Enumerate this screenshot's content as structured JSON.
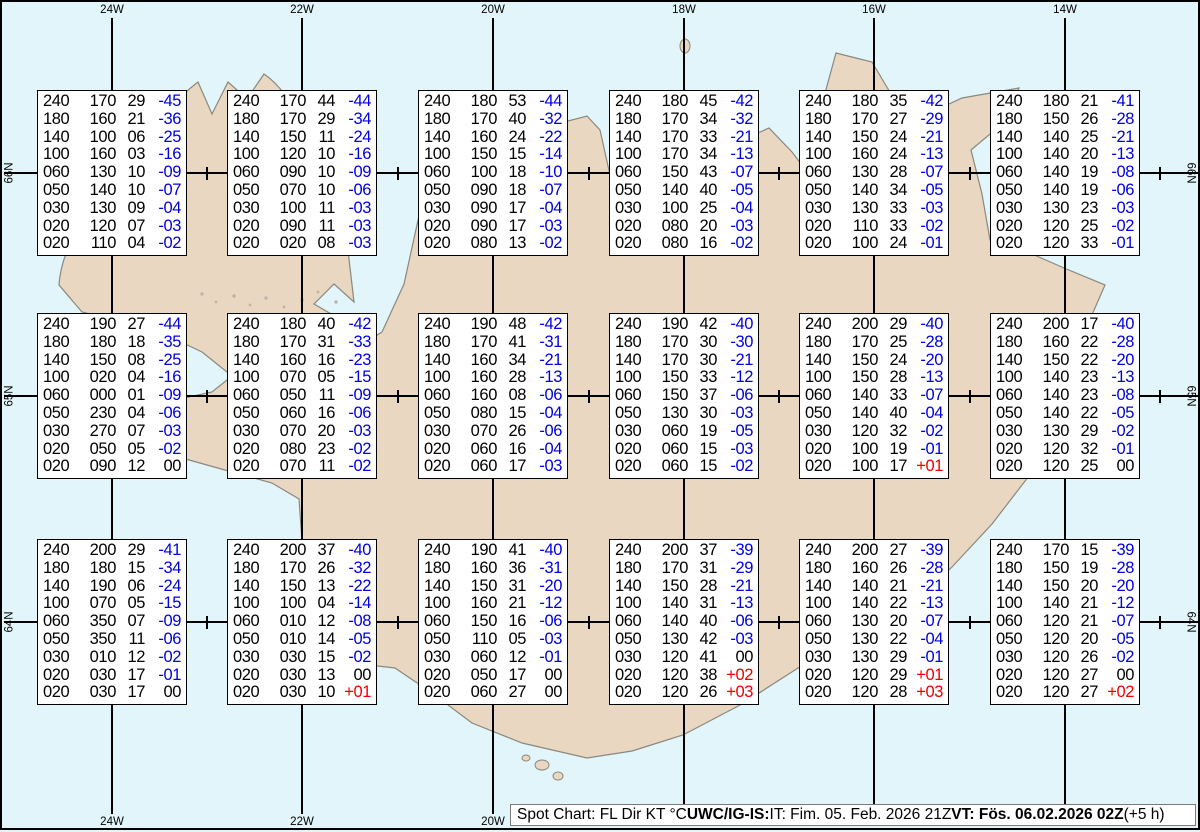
{
  "title": "Spot Chart UWC/IG-IS Iceland",
  "colors": {
    "sea": "#e1f5fa",
    "land": "#e9d7c2",
    "coastline": "#8a887e",
    "grid": "#000000",
    "temp_negative": "#0000e0",
    "temp_positive": "#ee0000",
    "temp_zero": "#000000",
    "box_bg": "#ffffff",
    "status_bg": "#ffffff"
  },
  "axes": {
    "top_labels": [
      "24W",
      "22W",
      "20W",
      "18W",
      "16W",
      "14W"
    ],
    "bottom_labels": [
      "24W",
      "22W",
      "20W"
    ],
    "left_labels": [
      "66N",
      "65N",
      "64N"
    ],
    "right_labels": [
      "66N",
      "65N",
      "64N"
    ]
  },
  "status_bar": {
    "segments": [
      {
        "text": "Spot Chart: FL Dir KT °C ",
        "bold": false
      },
      {
        "text": "UWC/IG-IS:",
        "bold": true
      },
      {
        "text": " IT: Fim. 05. Feb. 2026 21Z ",
        "bold": false
      },
      {
        "text": "VT: Fös. 06.02.2026 02Z",
        "bold": true
      },
      {
        "text": " (+5 h)",
        "bold": false
      }
    ]
  },
  "chart_data": {
    "type": "table",
    "title": "Spot Chart: FL Dir KT °C",
    "issued": "IT: Fim. 05. Feb. 2026 21Z",
    "valid": "VT: Fös. 06.02.2026 02Z (+5 h)",
    "columns": [
      "FL",
      "Dir",
      "KT",
      "°C"
    ],
    "grid_lons": [
      "24W",
      "22W",
      "20W",
      "18W",
      "16W",
      "14W"
    ],
    "grid_lats": [
      "66N",
      "65N",
      "64N"
    ],
    "stations": [
      {
        "row": 0,
        "col": 0,
        "rows": [
          [
            "240",
            "170",
            "29",
            "-45"
          ],
          [
            "180",
            "160",
            "21",
            "-36"
          ],
          [
            "140",
            "100",
            "06",
            "-25"
          ],
          [
            "100",
            "160",
            "03",
            "-16"
          ],
          [
            "060",
            "130",
            "10",
            "-09"
          ],
          [
            "050",
            "140",
            "10",
            "-07"
          ],
          [
            "030",
            "130",
            "09",
            "-04"
          ],
          [
            "020",
            "120",
            "07",
            "-03"
          ],
          [
            "020",
            "110",
            "04",
            "-02"
          ]
        ]
      },
      {
        "row": 0,
        "col": 1,
        "rows": [
          [
            "240",
            "170",
            "44",
            "-44"
          ],
          [
            "180",
            "170",
            "29",
            "-34"
          ],
          [
            "140",
            "150",
            "11",
            "-24"
          ],
          [
            "100",
            "120",
            "10",
            "-16"
          ],
          [
            "060",
            "090",
            "10",
            "-09"
          ],
          [
            "050",
            "070",
            "10",
            "-06"
          ],
          [
            "030",
            "100",
            "11",
            "-03"
          ],
          [
            "020",
            "090",
            "11",
            "-03"
          ],
          [
            "020",
            "020",
            "08",
            "-03"
          ]
        ]
      },
      {
        "row": 0,
        "col": 2,
        "rows": [
          [
            "240",
            "180",
            "53",
            "-44"
          ],
          [
            "180",
            "170",
            "40",
            "-32"
          ],
          [
            "140",
            "160",
            "24",
            "-22"
          ],
          [
            "100",
            "150",
            "15",
            "-14"
          ],
          [
            "060",
            "100",
            "18",
            "-10"
          ],
          [
            "050",
            "090",
            "18",
            "-07"
          ],
          [
            "030",
            "090",
            "17",
            "-04"
          ],
          [
            "020",
            "090",
            "17",
            "-03"
          ],
          [
            "020",
            "080",
            "13",
            "-02"
          ]
        ]
      },
      {
        "row": 0,
        "col": 3,
        "rows": [
          [
            "240",
            "180",
            "45",
            "-42"
          ],
          [
            "180",
            "170",
            "34",
            "-32"
          ],
          [
            "140",
            "170",
            "33",
            "-21"
          ],
          [
            "100",
            "170",
            "34",
            "-13"
          ],
          [
            "060",
            "150",
            "43",
            "-07"
          ],
          [
            "050",
            "140",
            "40",
            "-05"
          ],
          [
            "030",
            "100",
            "25",
            "-04"
          ],
          [
            "020",
            "080",
            "20",
            "-03"
          ],
          [
            "020",
            "080",
            "16",
            "-02"
          ]
        ]
      },
      {
        "row": 0,
        "col": 4,
        "rows": [
          [
            "240",
            "180",
            "35",
            "-42"
          ],
          [
            "180",
            "170",
            "27",
            "-29"
          ],
          [
            "140",
            "150",
            "24",
            "-21"
          ],
          [
            "100",
            "160",
            "24",
            "-13"
          ],
          [
            "060",
            "130",
            "28",
            "-07"
          ],
          [
            "050",
            "140",
            "34",
            "-05"
          ],
          [
            "030",
            "130",
            "33",
            "-03"
          ],
          [
            "020",
            "110",
            "33",
            "-02"
          ],
          [
            "020",
            "100",
            "24",
            "-01"
          ]
        ]
      },
      {
        "row": 0,
        "col": 5,
        "rows": [
          [
            "240",
            "180",
            "21",
            "-41"
          ],
          [
            "180",
            "150",
            "26",
            "-28"
          ],
          [
            "140",
            "140",
            "25",
            "-21"
          ],
          [
            "100",
            "140",
            "20",
            "-13"
          ],
          [
            "060",
            "140",
            "19",
            "-08"
          ],
          [
            "050",
            "140",
            "19",
            "-06"
          ],
          [
            "030",
            "130",
            "23",
            "-03"
          ],
          [
            "020",
            "120",
            "25",
            "-02"
          ],
          [
            "020",
            "120",
            "33",
            "-01"
          ]
        ]
      },
      {
        "row": 1,
        "col": 0,
        "rows": [
          [
            "240",
            "190",
            "27",
            "-44"
          ],
          [
            "180",
            "180",
            "18",
            "-35"
          ],
          [
            "140",
            "150",
            "08",
            "-25"
          ],
          [
            "100",
            "020",
            "04",
            "-16"
          ],
          [
            "060",
            "000",
            "01",
            "-09"
          ],
          [
            "050",
            "230",
            "04",
            "-06"
          ],
          [
            "030",
            "270",
            "07",
            "-03"
          ],
          [
            "020",
            "050",
            "05",
            "-02"
          ],
          [
            "020",
            "090",
            "12",
            "00"
          ]
        ]
      },
      {
        "row": 1,
        "col": 1,
        "rows": [
          [
            "240",
            "180",
            "40",
            "-42"
          ],
          [
            "180",
            "170",
            "31",
            "-33"
          ],
          [
            "140",
            "160",
            "16",
            "-23"
          ],
          [
            "100",
            "070",
            "05",
            "-15"
          ],
          [
            "060",
            "050",
            "11",
            "-09"
          ],
          [
            "050",
            "060",
            "16",
            "-06"
          ],
          [
            "030",
            "070",
            "20",
            "-03"
          ],
          [
            "020",
            "080",
            "23",
            "-02"
          ],
          [
            "020",
            "070",
            "11",
            "-02"
          ]
        ]
      },
      {
        "row": 1,
        "col": 2,
        "rows": [
          [
            "240",
            "190",
            "48",
            "-42"
          ],
          [
            "180",
            "170",
            "41",
            "-31"
          ],
          [
            "140",
            "160",
            "34",
            "-21"
          ],
          [
            "100",
            "160",
            "28",
            "-13"
          ],
          [
            "060",
            "160",
            "08",
            "-06"
          ],
          [
            "050",
            "080",
            "15",
            "-04"
          ],
          [
            "030",
            "070",
            "26",
            "-06"
          ],
          [
            "020",
            "060",
            "16",
            "-04"
          ],
          [
            "020",
            "060",
            "17",
            "-03"
          ]
        ]
      },
      {
        "row": 1,
        "col": 3,
        "rows": [
          [
            "240",
            "190",
            "42",
            "-40"
          ],
          [
            "180",
            "170",
            "30",
            "-30"
          ],
          [
            "140",
            "170",
            "30",
            "-21"
          ],
          [
            "100",
            "150",
            "33",
            "-12"
          ],
          [
            "060",
            "150",
            "37",
            "-06"
          ],
          [
            "050",
            "130",
            "30",
            "-03"
          ],
          [
            "030",
            "060",
            "19",
            "-05"
          ],
          [
            "020",
            "060",
            "15",
            "-03"
          ],
          [
            "020",
            "060",
            "15",
            "-02"
          ]
        ]
      },
      {
        "row": 1,
        "col": 4,
        "rows": [
          [
            "240",
            "200",
            "29",
            "-40"
          ],
          [
            "180",
            "170",
            "25",
            "-28"
          ],
          [
            "140",
            "150",
            "24",
            "-20"
          ],
          [
            "100",
            "150",
            "28",
            "-13"
          ],
          [
            "060",
            "140",
            "33",
            "-07"
          ],
          [
            "050",
            "140",
            "40",
            "-04"
          ],
          [
            "030",
            "120",
            "32",
            "-02"
          ],
          [
            "020",
            "100",
            "19",
            "-01"
          ],
          [
            "020",
            "100",
            "17",
            "+01"
          ]
        ]
      },
      {
        "row": 1,
        "col": 5,
        "rows": [
          [
            "240",
            "200",
            "17",
            "-40"
          ],
          [
            "180",
            "160",
            "22",
            "-28"
          ],
          [
            "140",
            "150",
            "22",
            "-20"
          ],
          [
            "100",
            "140",
            "23",
            "-13"
          ],
          [
            "060",
            "140",
            "23",
            "-08"
          ],
          [
            "050",
            "140",
            "22",
            "-05"
          ],
          [
            "030",
            "130",
            "29",
            "-02"
          ],
          [
            "020",
            "120",
            "32",
            "-01"
          ],
          [
            "020",
            "120",
            "25",
            "00"
          ]
        ]
      },
      {
        "row": 2,
        "col": 0,
        "rows": [
          [
            "240",
            "200",
            "29",
            "-41"
          ],
          [
            "180",
            "180",
            "15",
            "-34"
          ],
          [
            "140",
            "190",
            "06",
            "-24"
          ],
          [
            "100",
            "070",
            "05",
            "-15"
          ],
          [
            "060",
            "350",
            "07",
            "-09"
          ],
          [
            "050",
            "350",
            "11",
            "-06"
          ],
          [
            "030",
            "010",
            "12",
            "-02"
          ],
          [
            "020",
            "030",
            "17",
            "-01"
          ],
          [
            "020",
            "030",
            "17",
            "00"
          ]
        ]
      },
      {
        "row": 2,
        "col": 1,
        "rows": [
          [
            "240",
            "200",
            "37",
            "-40"
          ],
          [
            "180",
            "170",
            "26",
            "-32"
          ],
          [
            "140",
            "150",
            "13",
            "-22"
          ],
          [
            "100",
            "100",
            "04",
            "-14"
          ],
          [
            "060",
            "010",
            "12",
            "-08"
          ],
          [
            "050",
            "010",
            "14",
            "-05"
          ],
          [
            "030",
            "030",
            "15",
            "-02"
          ],
          [
            "020",
            "030",
            "13",
            "00"
          ],
          [
            "020",
            "030",
            "10",
            "+01"
          ]
        ]
      },
      {
        "row": 2,
        "col": 2,
        "rows": [
          [
            "240",
            "190",
            "41",
            "-40"
          ],
          [
            "180",
            "160",
            "36",
            "-31"
          ],
          [
            "140",
            "150",
            "31",
            "-20"
          ],
          [
            "100",
            "160",
            "21",
            "-12"
          ],
          [
            "060",
            "150",
            "16",
            "-06"
          ],
          [
            "050",
            "110",
            "05",
            "-03"
          ],
          [
            "030",
            "060",
            "12",
            "-01"
          ],
          [
            "020",
            "050",
            "17",
            "00"
          ],
          [
            "020",
            "060",
            "27",
            "00"
          ]
        ]
      },
      {
        "row": 2,
        "col": 3,
        "rows": [
          [
            "240",
            "200",
            "37",
            "-39"
          ],
          [
            "180",
            "170",
            "31",
            "-29"
          ],
          [
            "140",
            "150",
            "28",
            "-21"
          ],
          [
            "100",
            "140",
            "31",
            "-13"
          ],
          [
            "060",
            "140",
            "40",
            "-06"
          ],
          [
            "050",
            "130",
            "42",
            "-03"
          ],
          [
            "030",
            "120",
            "41",
            "00"
          ],
          [
            "020",
            "120",
            "38",
            "+02"
          ],
          [
            "020",
            "120",
            "26",
            "+03"
          ]
        ]
      },
      {
        "row": 2,
        "col": 4,
        "rows": [
          [
            "240",
            "200",
            "27",
            "-39"
          ],
          [
            "180",
            "160",
            "26",
            "-28"
          ],
          [
            "140",
            "140",
            "21",
            "-21"
          ],
          [
            "100",
            "140",
            "22",
            "-13"
          ],
          [
            "060",
            "130",
            "20",
            "-07"
          ],
          [
            "050",
            "130",
            "22",
            "-04"
          ],
          [
            "030",
            "130",
            "29",
            "-01"
          ],
          [
            "020",
            "120",
            "29",
            "+01"
          ],
          [
            "020",
            "120",
            "28",
            "+03"
          ]
        ]
      },
      {
        "row": 2,
        "col": 5,
        "rows": [
          [
            "240",
            "170",
            "15",
            "-39"
          ],
          [
            "180",
            "150",
            "19",
            "-28"
          ],
          [
            "140",
            "150",
            "20",
            "-20"
          ],
          [
            "100",
            "140",
            "21",
            "-12"
          ],
          [
            "060",
            "120",
            "21",
            "-07"
          ],
          [
            "050",
            "120",
            "20",
            "-05"
          ],
          [
            "030",
            "120",
            "26",
            "-02"
          ],
          [
            "020",
            "120",
            "27",
            "00"
          ],
          [
            "020",
            "120",
            "27",
            "+02"
          ]
        ]
      }
    ]
  }
}
